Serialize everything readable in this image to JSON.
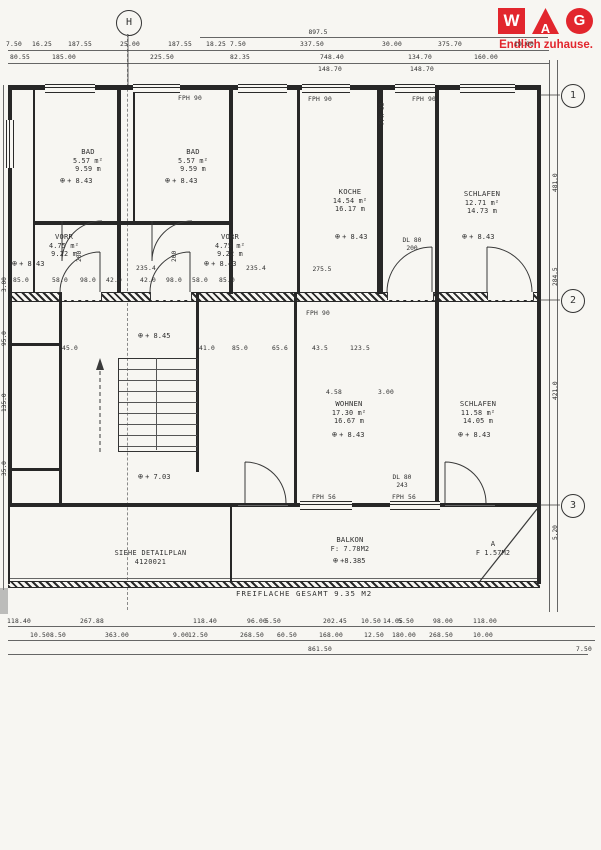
{
  "logo": {
    "letter_w": "W",
    "letter_a": "A",
    "letter_g": "G",
    "tagline": "Endlich zuhause.",
    "brand_red": "#e2262d"
  },
  "axes": {
    "h": "H",
    "a1": "1",
    "a2": "2",
    "a3": "3"
  },
  "icons": {
    "level": "⊕"
  },
  "rooms": {
    "bad_left": {
      "name": "BAD",
      "area": "5.57 m²",
      "perimeter": "9.59 m",
      "level": "+ 8.43"
    },
    "bad_right": {
      "name": "BAD",
      "area": "5.57 m²",
      "perimeter": "9.59 m",
      "level": "+ 8.43"
    },
    "vorr_left": {
      "name": "VORR",
      "area": "4.75 m²",
      "perimeter": "9.22 m",
      "level": "+ 8.43"
    },
    "vorr_right": {
      "name": "VORR",
      "area": "4.75 m²",
      "perimeter": "9.22 m",
      "level": "+ 8.43"
    },
    "koche": {
      "name": "KOCHE",
      "area": "14.54 m²",
      "perimeter": "16.17 m",
      "level": "+ 8.43"
    },
    "schlafen_top": {
      "name": "SCHLAFEN",
      "area": "12.71 m²",
      "perimeter": "14.73 m",
      "level": "+ 8.43"
    },
    "wohnen": {
      "name": "WOHNEN",
      "area": "17.30 m²",
      "perimeter": "16.67 m",
      "level": "+ 8.43"
    },
    "schlafen_bottom": {
      "name": "SCHLAFEN",
      "area": "11.58 m²",
      "perimeter": "14.05 m",
      "level": "+ 8.43"
    },
    "balkon": {
      "name": "BALKON",
      "area": "F: 7.78M2",
      "level": "+8.385"
    },
    "abstell": {
      "name": "A",
      "area": "F 1.57M2"
    }
  },
  "levels": {
    "stair_upper": "+ 8.45",
    "landing": "+ 7.03"
  },
  "notes": {
    "detail_line1": "SIEHE DETAILPLAN",
    "detail_line2": "4120021",
    "freiflaeche": "FREIFLACHE GESAMT  9.35 M2"
  },
  "fittings": {
    "fph90": "FPH 90",
    "fph56": "FPH 56",
    "dl80": "DL 80",
    "dl200": "200",
    "dl243": "243"
  },
  "dims": {
    "top_total": "897.5",
    "koche_width": "275.5",
    "top_row1": [
      {
        "t": "7.50",
        "x": 14
      },
      {
        "t": "16.25",
        "x": 42
      },
      {
        "t": "187.55",
        "x": 80
      },
      {
        "t": "25.00",
        "x": 130
      },
      {
        "t": "187.55",
        "x": 180
      },
      {
        "t": "18.25",
        "x": 216
      },
      {
        "t": "7.50",
        "x": 238
      },
      {
        "t": "337.50",
        "x": 312
      },
      {
        "t": "30.00",
        "x": 392
      },
      {
        "t": "375.70",
        "x": 450
      },
      {
        "t": "19.00",
        "x": 524
      }
    ],
    "top_row2": [
      {
        "t": "80.55",
        "x": 20
      },
      {
        "t": "185.00",
        "x": 64
      },
      {
        "t": "225.50",
        "x": 162
      },
      {
        "t": "82.35",
        "x": 240
      },
      {
        "t": "748.40",
        "x": 332
      },
      {
        "t": "134.70",
        "x": 420
      },
      {
        "t": "160.00",
        "x": 486
      }
    ],
    "top_row3": [
      {
        "t": "148.70",
        "x": 330
      },
      {
        "t": "148.70",
        "x": 422
      }
    ],
    "vorr_widths": [
      {
        "t": "235.4",
        "x": 146
      },
      {
        "t": "235.4",
        "x": 256
      }
    ],
    "vorr_row": [
      {
        "t": "85.0",
        "x": 21
      },
      {
        "t": "58.0",
        "x": 60
      },
      {
        "t": "98.0",
        "x": 88
      },
      {
        "t": "42.0",
        "x": 114
      },
      {
        "t": "42.0",
        "x": 148
      },
      {
        "t": "98.0",
        "x": 174
      },
      {
        "t": "58.0",
        "x": 200
      },
      {
        "t": "85.0",
        "x": 227
      }
    ],
    "mid_row": [
      {
        "t": "45.0",
        "x": 70
      },
      {
        "t": "41.0",
        "x": 207
      },
      {
        "t": "85.0",
        "x": 240
      },
      {
        "t": "65.6",
        "x": 280
      },
      {
        "t": "43.5",
        "x": 320
      },
      {
        "t": "123.5",
        "x": 360
      }
    ],
    "wohnen_top": [
      {
        "t": "4.58",
        "x": 334
      },
      {
        "t": "3.00",
        "x": 386
      }
    ],
    "bottom_row1": [
      {
        "t": "118.40",
        "x": 19
      },
      {
        "t": "267.88",
        "x": 92
      },
      {
        "t": "118.40",
        "x": 205
      },
      {
        "t": "96.00",
        "x": 257
      },
      {
        "t": "5.50",
        "x": 273
      },
      {
        "t": "202.45",
        "x": 335
      },
      {
        "t": "10.50",
        "x": 371
      },
      {
        "t": "14.05",
        "x": 393
      },
      {
        "t": "5.50",
        "x": 406
      },
      {
        "t": "98.00",
        "x": 443
      },
      {
        "t": "118.00",
        "x": 485
      }
    ],
    "bottom_row2": [
      {
        "t": "10.50",
        "x": 40
      },
      {
        "t": "8.50",
        "x": 58
      },
      {
        "t": "363.00",
        "x": 117
      },
      {
        "t": "9.00",
        "x": 181
      },
      {
        "t": "12.50",
        "x": 198
      },
      {
        "t": "268.50",
        "x": 252
      },
      {
        "t": "60.50",
        "x": 287
      },
      {
        "t": "168.00",
        "x": 331
      },
      {
        "t": "12.50",
        "x": 374
      },
      {
        "t": "180.00",
        "x": 404
      },
      {
        "t": "268.50",
        "x": 441
      },
      {
        "t": "10.00",
        "x": 483
      }
    ],
    "bottom_row3": [
      {
        "t": "861.50",
        "x": 320
      },
      {
        "t": "7.50",
        "x": 584
      }
    ],
    "left_col": [
      {
        "t": "3.00",
        "y": 292
      },
      {
        "t": "95.0",
        "y": 346
      },
      {
        "t": "135.0",
        "y": 412
      },
      {
        "t": "35.0",
        "y": 476
      }
    ],
    "right_col": [
      {
        "t": "481.0",
        "y": 192
      },
      {
        "t": "284.5",
        "y": 286
      },
      {
        "t": "421.0",
        "y": 400
      },
      {
        "t": "5.20",
        "y": 540
      }
    ]
  }
}
